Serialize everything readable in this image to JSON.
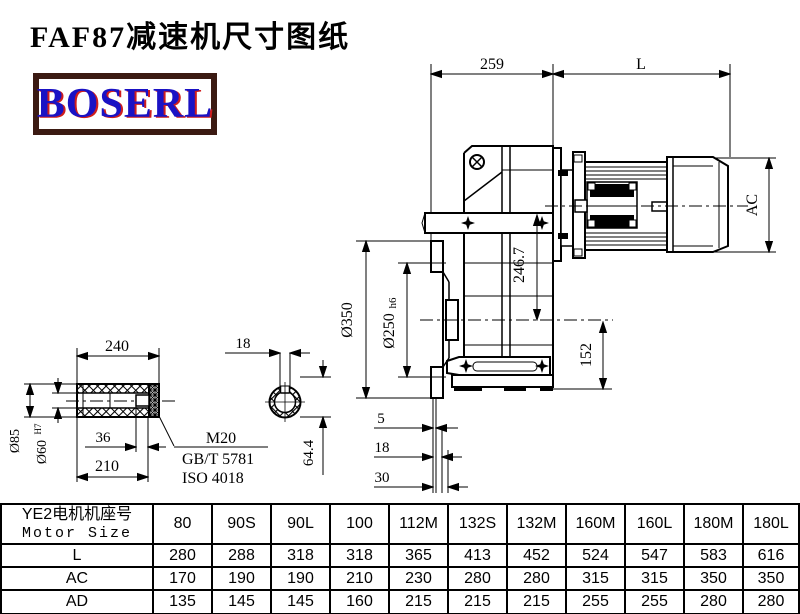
{
  "title": "FAF87减速机尺寸图纸",
  "logo_text": "BOSERL",
  "colors": {
    "line": "#000000",
    "logo_border": "#3b1a12",
    "logo_text_color": "#1a12c4",
    "logo_shadow": "#cf1d1d"
  },
  "dims": {
    "d259": "259",
    "dL": "L",
    "dAC": "AC",
    "d246": "246.7",
    "d152": "152",
    "d350": "Ø350",
    "d250": "Ø250",
    "d250tol": "h6",
    "d5": "5",
    "d18b": "18",
    "d30": "30",
    "d240": "240",
    "d85": "Ø85",
    "d60": "Ø60",
    "d60tol": "H7",
    "d36": "36",
    "d210": "210",
    "m20": "M20",
    "gb": "GB/T 5781",
    "iso": "ISO 4018",
    "d18": "18",
    "d644": "64.4"
  },
  "table": {
    "header_cn": "YE2电机机座号",
    "header_en": "Motor Size",
    "columns": [
      "80",
      "90S",
      "90L",
      "100",
      "112M",
      "132S",
      "132M",
      "160M",
      "160L",
      "180M",
      "180L"
    ],
    "rows": [
      {
        "label": "L",
        "values": [
          "280",
          "288",
          "318",
          "318",
          "365",
          "413",
          "452",
          "524",
          "547",
          "583",
          "616"
        ]
      },
      {
        "label": "AC",
        "values": [
          "170",
          "190",
          "190",
          "210",
          "230",
          "280",
          "280",
          "315",
          "315",
          "350",
          "350"
        ]
      },
      {
        "label": "AD",
        "values": [
          "135",
          "145",
          "145",
          "160",
          "215",
          "215",
          "215",
          "255",
          "255",
          "280",
          "280"
        ]
      }
    ]
  }
}
